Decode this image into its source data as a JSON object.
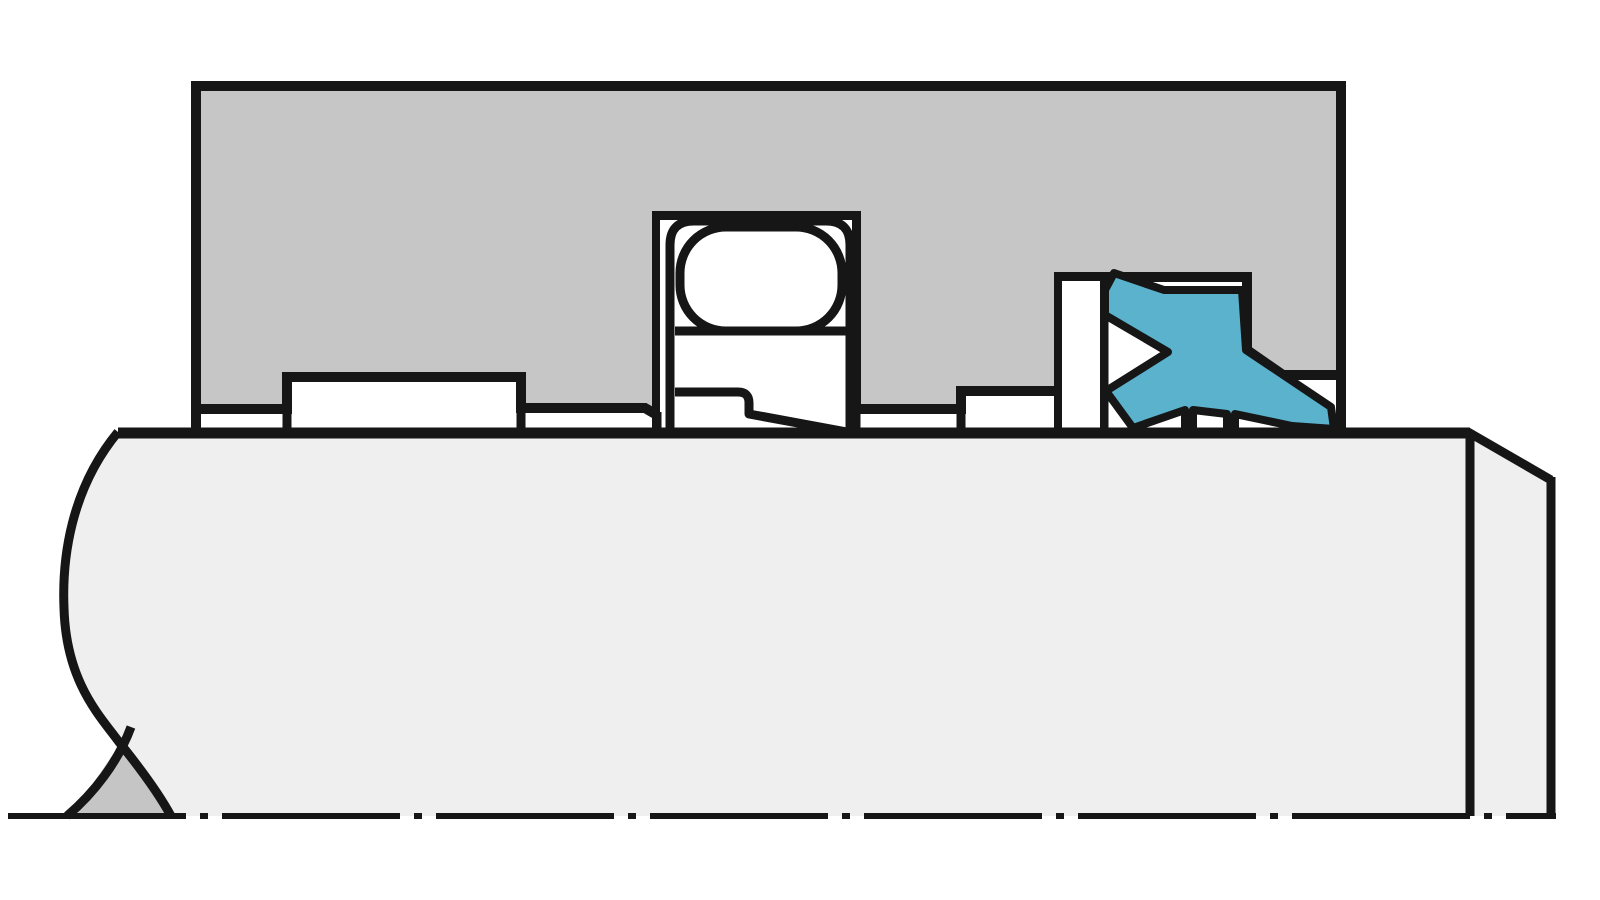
{
  "canvas": {
    "width": 1600,
    "height": 900,
    "background": "#ffffff"
  },
  "colors": {
    "outline": "#161616",
    "housing_gray": "#c6c6c6",
    "shaft_gray": "#efefef",
    "break_wedge_gray": "#c5c5c5",
    "seal_blue": "#5ab2cd",
    "white": "#ffffff"
  },
  "shapes": [
    {
      "name": "shaft-body",
      "type": "path",
      "d": "M 118 433 L 1470 433 L 1551 480 L 1551 816 L 171 816 C 158 792 140 768 119 742 C 100 716 66 682 64 608 C 62 560 70 490 118 433 Z",
      "fill": "#efefef",
      "stroke": "none"
    },
    {
      "name": "shaft-break-wedge",
      "type": "path",
      "d": "M 120 744 L 71 816 L 171 816 Z",
      "fill": "#c5c5c5",
      "stroke": "none"
    },
    {
      "name": "shaft-break-curve-outer",
      "type": "path",
      "d": "M 118 432 C 70 490 62 560 64 608 C 66 682 100 716 119 742 C 140 768 158 792 171 816",
      "fill": "none",
      "stroke": "#161616",
      "sw": 9
    },
    {
      "name": "shaft-break-curve-inner",
      "type": "path",
      "d": "M 131 727 C 118 762 94 793 67 816",
      "fill": "none",
      "stroke": "#161616",
      "sw": 9
    },
    {
      "name": "housing-block",
      "type": "path",
      "d": "M 196 86 L 1341 86 L 1341 375 L 1283 375 L 1247 350 L 1247 277 L 1059 277 L 1059 391 L 961 391 L 961 409 L 856 409 L 856 216 L 657 216 L 657 415 L 645 408 L 521 408 L 521 377 L 287 377 L 287 409 L 196 409 Z",
      "fill": "#c6c6c6",
      "stroke": "#161616",
      "sw": 10
    },
    {
      "name": "bearing-bore-box",
      "type": "rect",
      "x": 656,
      "y": 216,
      "w": 200,
      "h": 217,
      "rx": 0,
      "fill": "#ffffff",
      "stroke": "#161616",
      "sw": 8
    },
    {
      "name": "bearing-outer-ring",
      "type": "path",
      "d": "M 670 433 L 670 245 Q 670 221 694 221 L 826 221 Q 850 221 850 245 L 850 433 Z",
      "fill": "#ffffff",
      "stroke": "#161616",
      "sw": 9
    },
    {
      "name": "bearing-ball",
      "type": "rect",
      "x": 680,
      "y": 227,
      "w": 162,
      "h": 104,
      "rx": 46,
      "fill": "#ffffff",
      "stroke": "#161616",
      "sw": 9
    },
    {
      "name": "bearing-inner-ring-top-line",
      "type": "line",
      "x1": 675,
      "y1": 331,
      "x2": 846,
      "y2": 331,
      "fill": "none",
      "stroke": "#161616",
      "sw": 9
    },
    {
      "name": "bearing-inner-ring-step",
      "type": "path",
      "d": "M 675 392 L 738 392 Q 749 392 749 403 L 749 414 L 847 432",
      "fill": "none",
      "stroke": "#161616",
      "sw": 9,
      "linejoin": "round"
    },
    {
      "name": "housing-left-edge-lower",
      "type": "line",
      "x1": 196,
      "y1": 406,
      "x2": 196,
      "y2": 437,
      "stroke": "#161616",
      "sw": 10
    },
    {
      "name": "left-recess-left-wall-lower",
      "type": "line",
      "x1": 287,
      "y1": 406,
      "x2": 287,
      "y2": 437,
      "stroke": "#161616",
      "sw": 9
    },
    {
      "name": "left-recess-right-wall-lower",
      "type": "line",
      "x1": 521,
      "y1": 406,
      "x2": 521,
      "y2": 437,
      "stroke": "#161616",
      "sw": 9
    },
    {
      "name": "bore-left-wall-lower",
      "type": "line",
      "x1": 657,
      "y1": 412,
      "x2": 657,
      "y2": 437,
      "stroke": "#161616",
      "sw": 9
    },
    {
      "name": "bore-right-wall-lower",
      "type": "line",
      "x1": 856,
      "y1": 406,
      "x2": 856,
      "y2": 437,
      "stroke": "#161616",
      "sw": 9
    },
    {
      "name": "right-recess-left-wall-lower",
      "type": "line",
      "x1": 961,
      "y1": 406,
      "x2": 961,
      "y2": 437,
      "stroke": "#161616",
      "sw": 9
    },
    {
      "name": "seal-groove-left-wall-lower",
      "type": "line",
      "x1": 1059,
      "y1": 388,
      "x2": 1059,
      "y2": 437,
      "stroke": "#161616",
      "sw": 9
    },
    {
      "name": "seal-retainer-right-wall",
      "type": "line",
      "x1": 1104,
      "y1": 279,
      "x2": 1104,
      "y2": 437,
      "stroke": "#161616",
      "sw": 9
    },
    {
      "name": "housing-right-edge-lower",
      "type": "line",
      "x1": 1341,
      "y1": 372,
      "x2": 1341,
      "y2": 437,
      "stroke": "#161616",
      "sw": 10
    },
    {
      "name": "seal-retainer-washer",
      "type": "rect",
      "x": 1058,
      "y": 277,
      "w": 46,
      "h": 157,
      "rx": 0,
      "fill": "#ffffff",
      "stroke": "#161616",
      "sw": 8
    },
    {
      "name": "seal-ring",
      "type": "path",
      "d": "M 1114 273 L 1164 290 L 1242 290 L 1246 350 L 1331 407 L 1334 429 L 1292 426 L 1235 414 L 1235 429 L 1227 429 L 1227 414 L 1193 410 L 1193 429 L 1185 429 L 1185 410 L 1133 428 L 1106 391 L 1168 352 L 1105 315 L 1105 290 Z",
      "fill": "#5ab2cd",
      "stroke": "#161616",
      "sw": 8,
      "linejoin": "round"
    },
    {
      "name": "shaft-top-line",
      "type": "line",
      "x1": 118,
      "y1": 433,
      "x2": 1470,
      "y2": 433,
      "stroke": "#161616",
      "sw": 11
    },
    {
      "name": "shaft-shoulder-line",
      "type": "line",
      "x1": 1470,
      "y1": 433,
      "x2": 1470,
      "y2": 816,
      "stroke": "#161616",
      "sw": 9
    },
    {
      "name": "shaft-end-chamfer-line",
      "type": "line",
      "x1": 1468,
      "y1": 432,
      "x2": 1551,
      "y2": 480,
      "stroke": "#161616",
      "sw": 9
    },
    {
      "name": "shaft-end-edge",
      "type": "line",
      "x1": 1551,
      "y1": 477,
      "x2": 1551,
      "y2": 816,
      "stroke": "#161616",
      "sw": 9
    },
    {
      "name": "centerline",
      "type": "line",
      "x1": 8,
      "y1": 816,
      "x2": 1556,
      "y2": 816,
      "stroke": "#161616",
      "sw": 6,
      "dash": "178 14 8 14"
    }
  ]
}
